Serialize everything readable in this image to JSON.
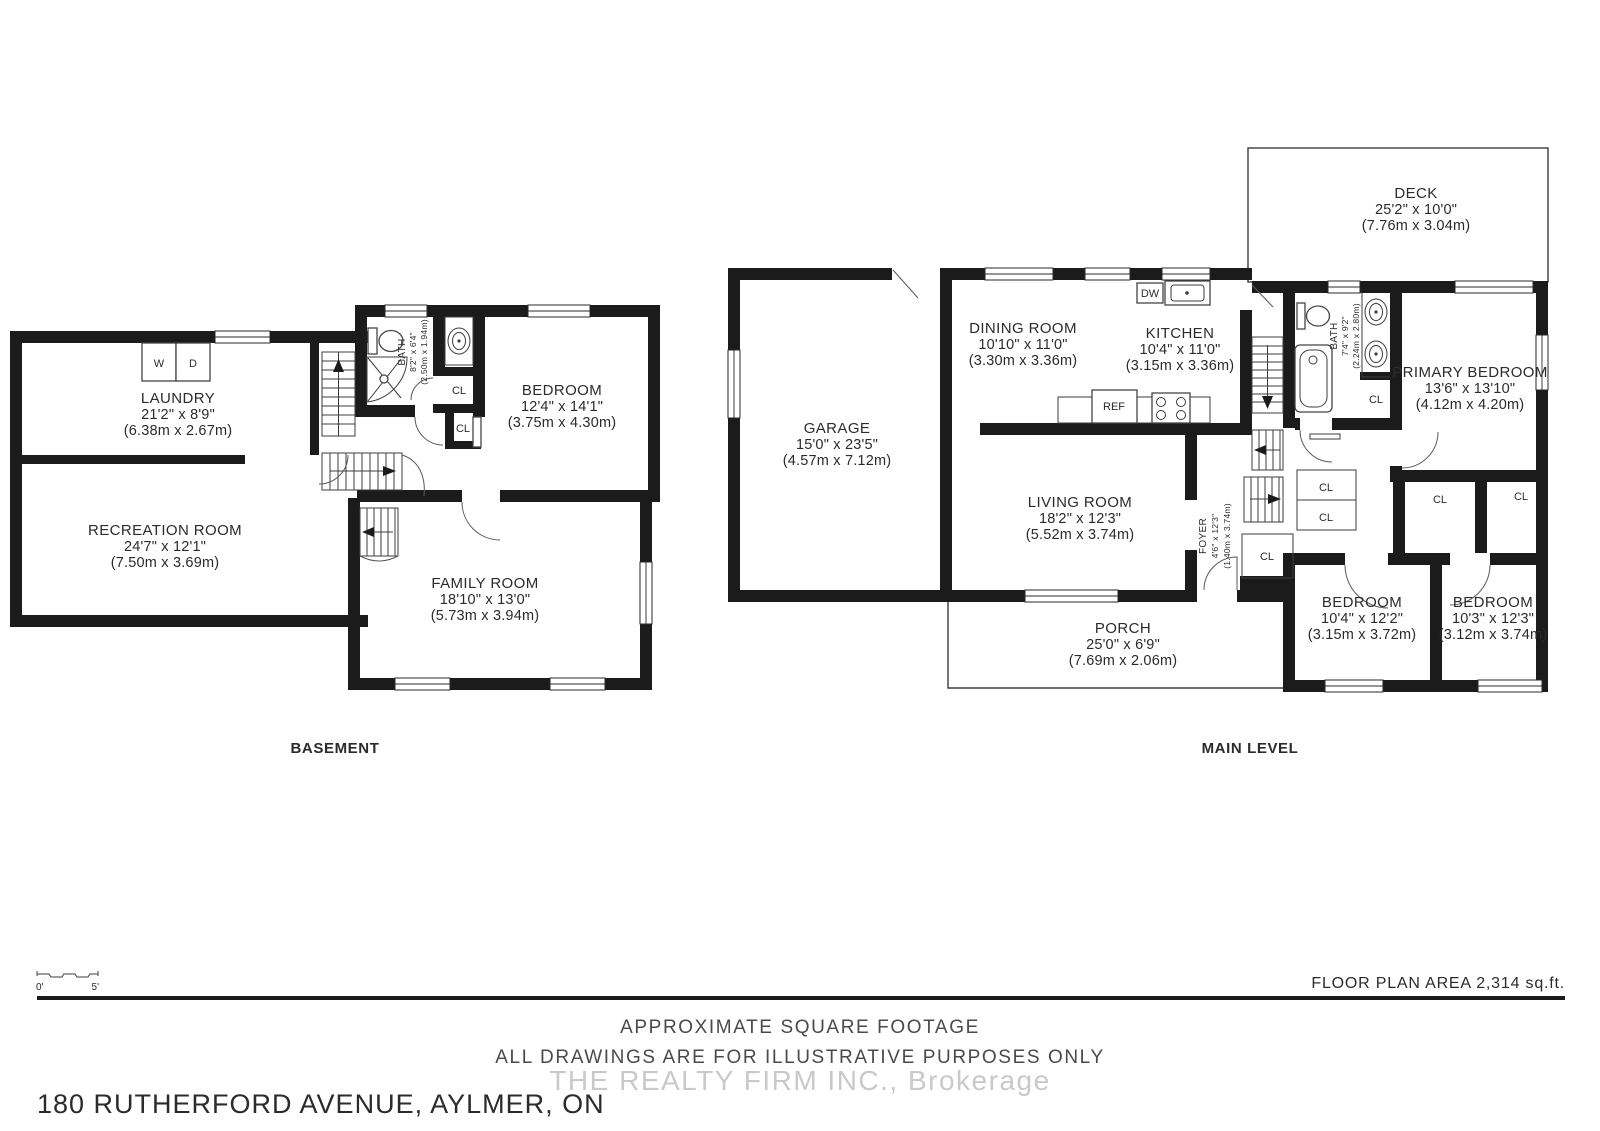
{
  "floors": {
    "basement": {
      "caption": "BASEMENT",
      "rooms": {
        "laundry": {
          "name": "LAUNDRY",
          "dims_ft": "21'2\" x 8'9\"",
          "dims_m": "(6.38m x 2.67m)"
        },
        "recreation": {
          "name": "RECREATION ROOM",
          "dims_ft": "24'7\" x 12'1\"",
          "dims_m": "(7.50m x 3.69m)"
        },
        "bath": {
          "name": "BATH",
          "dims_ft": "8'2\" x 6'4\"",
          "dims_m": "(2.50m x 1.94m)"
        },
        "bedroom": {
          "name": "BEDROOM",
          "dims_ft": "12'4\" x 14'1\"",
          "dims_m": "(3.75m x 4.30m)"
        },
        "family": {
          "name": "FAMILY ROOM",
          "dims_ft": "18'10\" x 13'0\"",
          "dims_m": "(5.73m x 3.94m)"
        }
      }
    },
    "main": {
      "caption": "MAIN LEVEL",
      "rooms": {
        "deck": {
          "name": "DECK",
          "dims_ft": "25'2\" x 10'0\"",
          "dims_m": "(7.76m x 3.04m)"
        },
        "garage": {
          "name": "GARAGE",
          "dims_ft": "15'0\" x 23'5\"",
          "dims_m": "(4.57m x 7.12m)"
        },
        "dining": {
          "name": "DINING ROOM",
          "dims_ft": "10'10\" x 11'0\"",
          "dims_m": "(3.30m x 3.36m)"
        },
        "kitchen": {
          "name": "KITCHEN",
          "dims_ft": "10'4\" x 11'0\"",
          "dims_m": "(3.15m x 3.36m)"
        },
        "living": {
          "name": "LIVING ROOM",
          "dims_ft": "18'2\" x 12'3\"",
          "dims_m": "(5.52m x 3.74m)"
        },
        "foyer": {
          "name": "FOYER",
          "dims_ft": "4'6\" x 12'3\"",
          "dims_m": "(1.40m x 3.74m)"
        },
        "bath": {
          "name": "BATH",
          "dims_ft": "7'4\" x 9'2\"",
          "dims_m": "(2.24m x 2.80m)"
        },
        "primary": {
          "name": "PRIMARY BEDROOM",
          "dims_ft": "13'6\" x 13'10\"",
          "dims_m": "(4.12m x 4.20m)"
        },
        "bedroom2": {
          "name": "BEDROOM",
          "dims_ft": "10'4\" x 12'2\"",
          "dims_m": "(3.15m x 3.72m)"
        },
        "bedroom3": {
          "name": "BEDROOM",
          "dims_ft": "10'3\" x 12'3\"",
          "dims_m": "(3.12m x 3.74m)"
        },
        "porch": {
          "name": "PORCH",
          "dims_ft": "25'0\" x 6'9\"",
          "dims_m": "(7.69m x 2.06m)"
        }
      }
    }
  },
  "fixture_labels": {
    "washer": "W",
    "dryer": "D",
    "dishwasher": "DW",
    "fridge": "REF",
    "closet": "CL"
  },
  "footer": {
    "scale_zero": "0'",
    "scale_five": "5'",
    "area_text": "FLOOR PLAN AREA 2,314 sq.ft.",
    "disclaimer1": "APPROXIMATE SQUARE FOOTAGE",
    "disclaimer2": "ALL DRAWINGS ARE FOR ILLUSTRATIVE PURPOSES ONLY",
    "watermark": "THE REALTY FIRM INC., Brokerage",
    "address": "180 RUTHERFORD AVENUE, AYLMER, ON"
  },
  "colors": {
    "wall": "#1b1b1b",
    "text": "#2b2b2b",
    "muted": "#4a4a4a",
    "watermark": "#c9c9c9"
  }
}
